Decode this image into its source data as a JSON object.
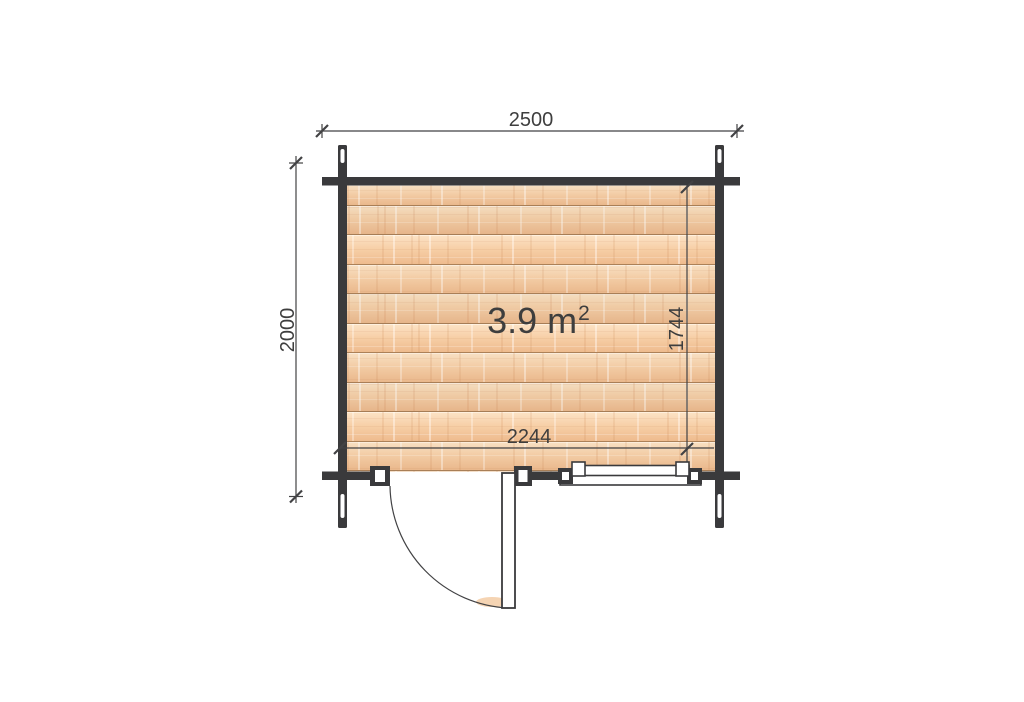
{
  "floorplan": {
    "area": {
      "value": "3.9 m",
      "superscript": "2"
    },
    "dims": {
      "overall_width": "2500",
      "overall_height": "2000",
      "interior_width": "2244",
      "interior_height": "1744"
    },
    "colors": {
      "wall": "#3a3a3c",
      "dim_line": "#424244",
      "label": "#3e3e3e",
      "floor_base": "#f3cda6",
      "floor_light": "#f8e0c3",
      "floor_dark": "#eab88c",
      "plank_seam": "#a97f57",
      "background": "#ffffff"
    },
    "features": {
      "door": "hinged-door-with-swing-arc",
      "window": "double-frame-window"
    }
  }
}
